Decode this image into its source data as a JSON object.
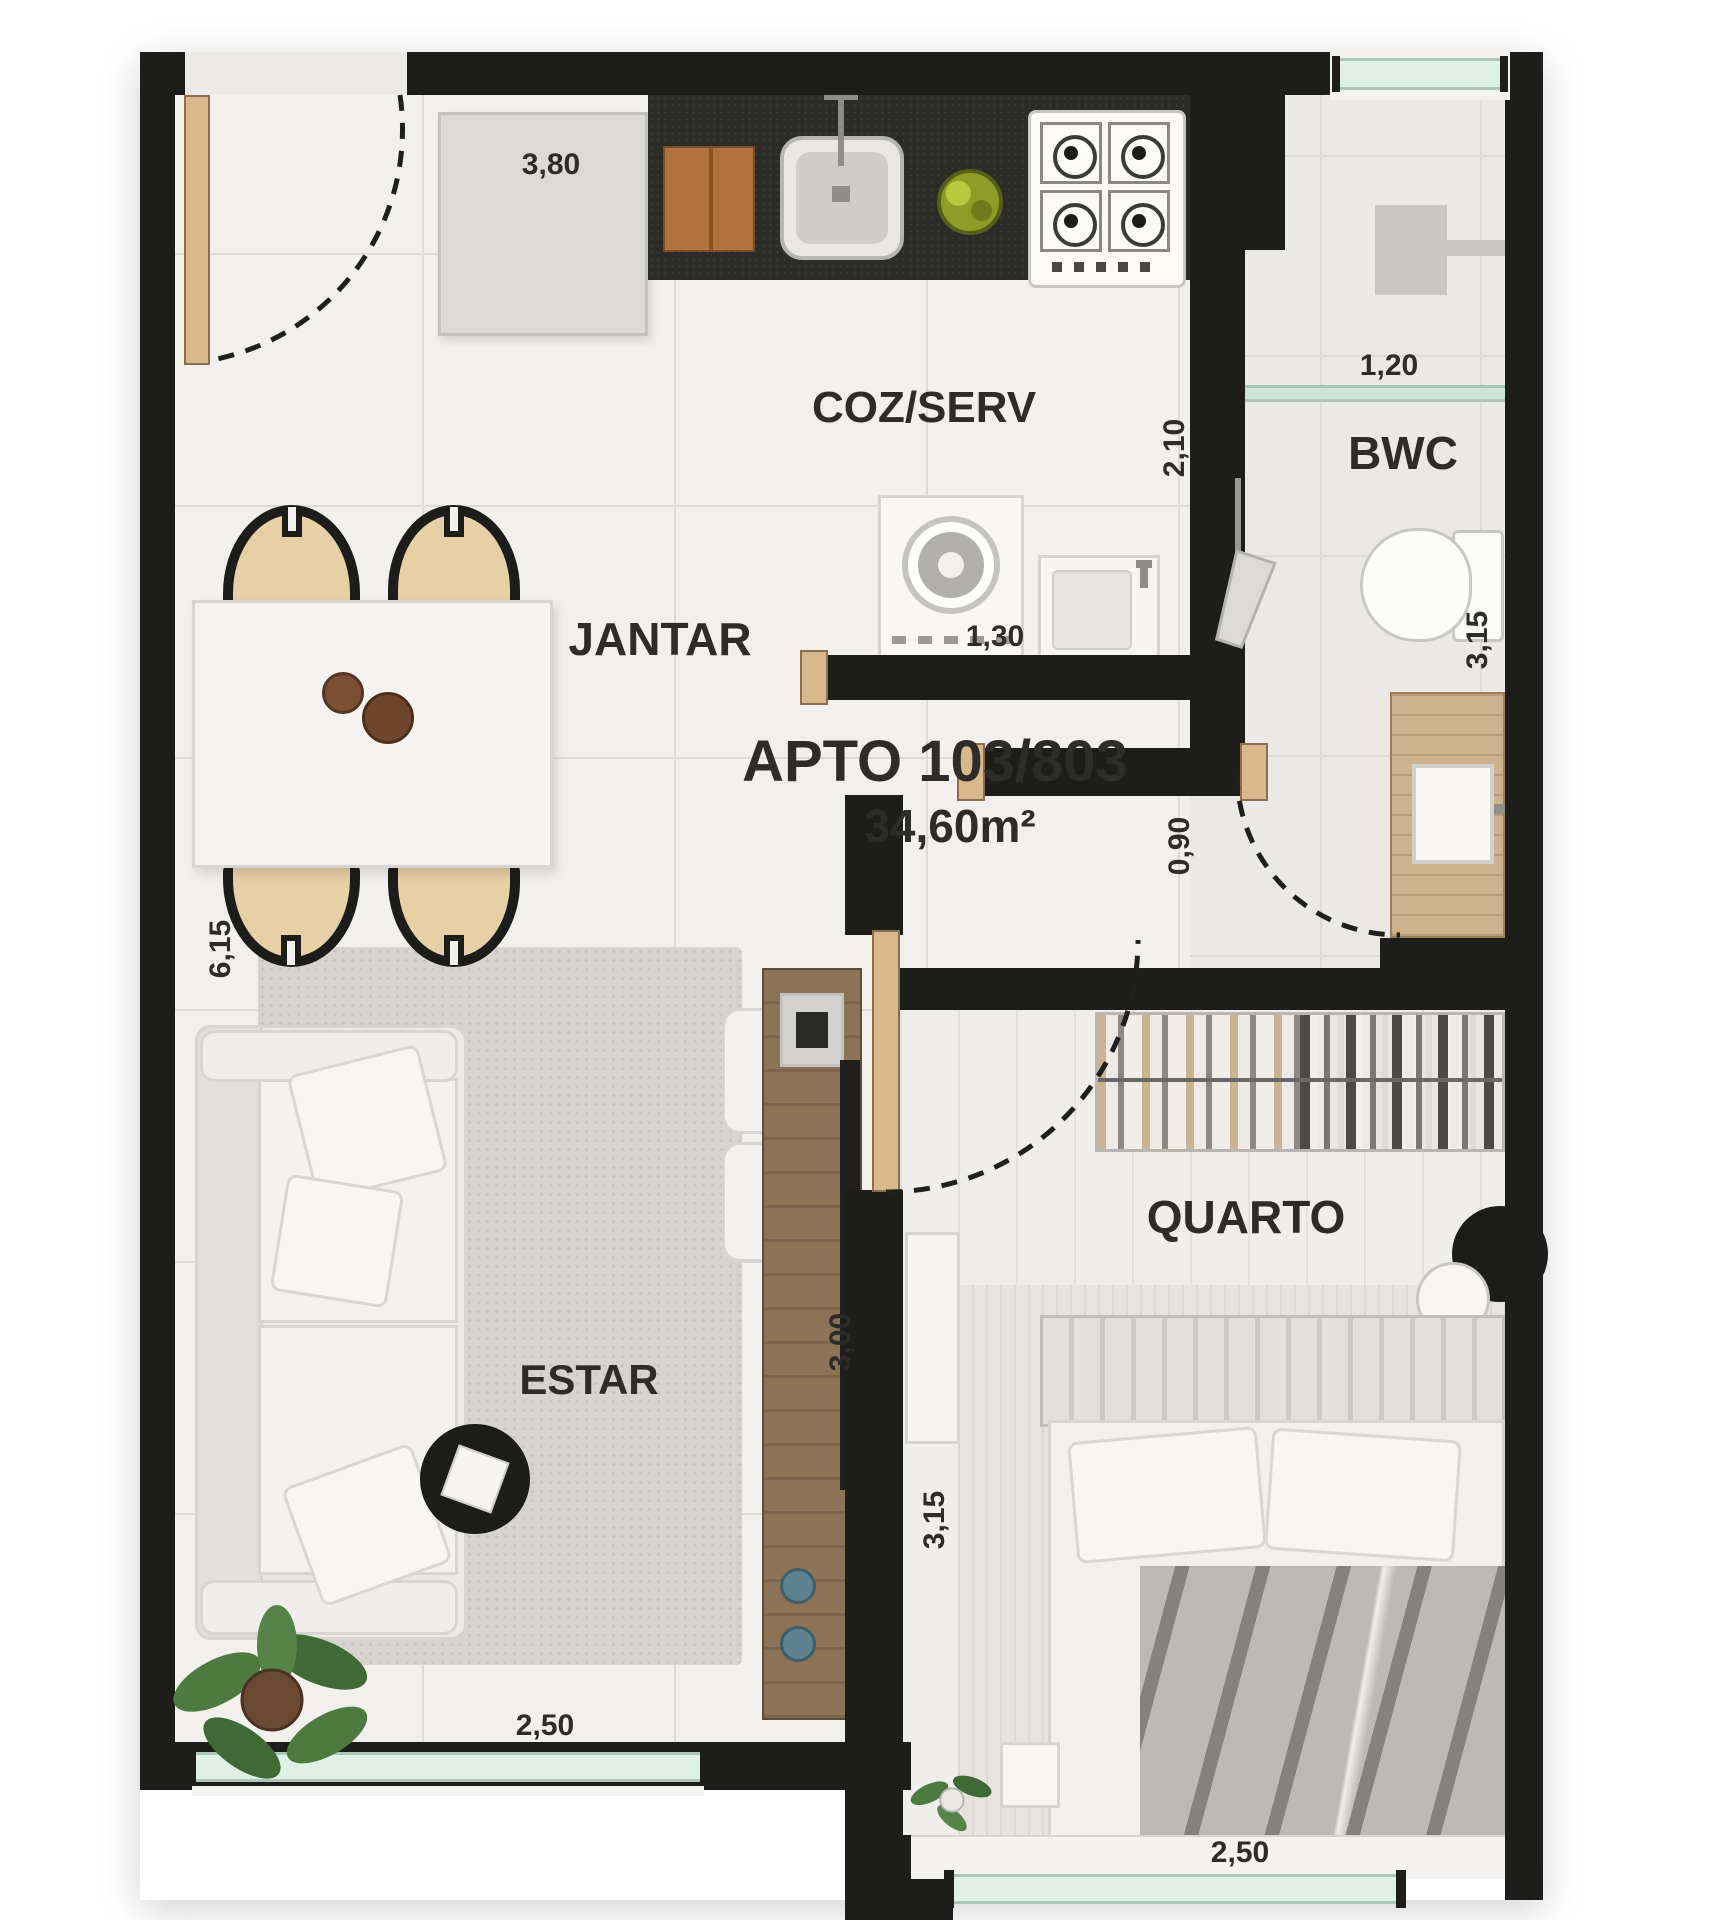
{
  "plan": {
    "title": "APTO 103/803",
    "area_label": "34,60m²",
    "rooms": {
      "kitchen_service": "COZ/SERV",
      "bathroom": "BWC",
      "dining": "JANTAR",
      "living": "ESTAR",
      "bedroom": "QUARTO"
    },
    "dimensions": {
      "kitchen_width": "3,80",
      "bwc_width": "1,20",
      "kitchen_depth": "2,10",
      "service_width": "1,30",
      "bwc_length": "3,15",
      "bedroom_door": "0,90",
      "living_length": "6,15",
      "living_width": "3,00",
      "bedroom_length": "3,15",
      "living_window": "2,50",
      "bedroom_window": "2,50"
    },
    "colors": {
      "wall": "#1d1d1b",
      "floor": "#f2f0ed",
      "glass": "#dff0e7",
      "wood": "#d9b98c",
      "counter": "#2b2b28",
      "text": "#2e2c2a",
      "greenery": "#4c7a3f"
    }
  }
}
